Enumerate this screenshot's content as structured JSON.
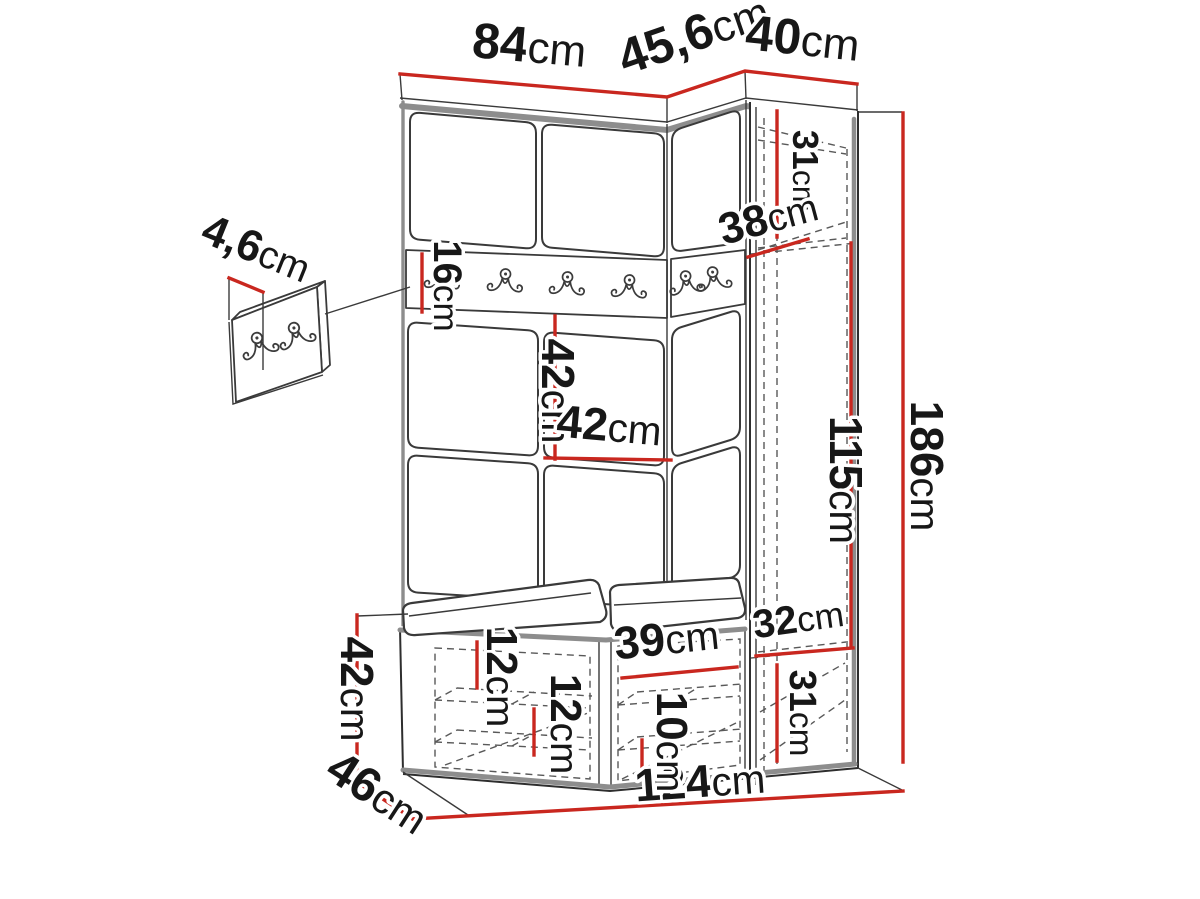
{
  "diagram": {
    "title": "hallway-furniture-set-dimension-drawing",
    "unit": "cm",
    "colors": {
      "dimension_line": "#c9271f",
      "outline": "#2e2e2e",
      "soft_edge": "#8d8d8d",
      "hidden_edge": "#595959",
      "background": "#ffffff"
    },
    "dimensions": {
      "top_left_width": "84cm",
      "top_corner_width": "45,6cm",
      "top_right_width": "40cm",
      "panel_thickness": "4,6cm",
      "hook_rail_height": "16cm",
      "cabinet_top_height": "31cm",
      "cabinet_depth": "38cm",
      "panel_height": "42cm",
      "panel_width": "42cm",
      "cabinet_middle_height": "115cm",
      "total_height": "186cm",
      "cabinet_bottom_width": "32cm",
      "cabinet_bottom_height": "31cm",
      "bench_height": "42cm",
      "bench_depth": "46cm",
      "total_width": "124cm",
      "shelf_spacing_a": "12cm",
      "shelf_spacing_b": "12cm",
      "shoe_compartment_width": "39cm",
      "shoe_shelf_spacing": "10cm"
    }
  }
}
